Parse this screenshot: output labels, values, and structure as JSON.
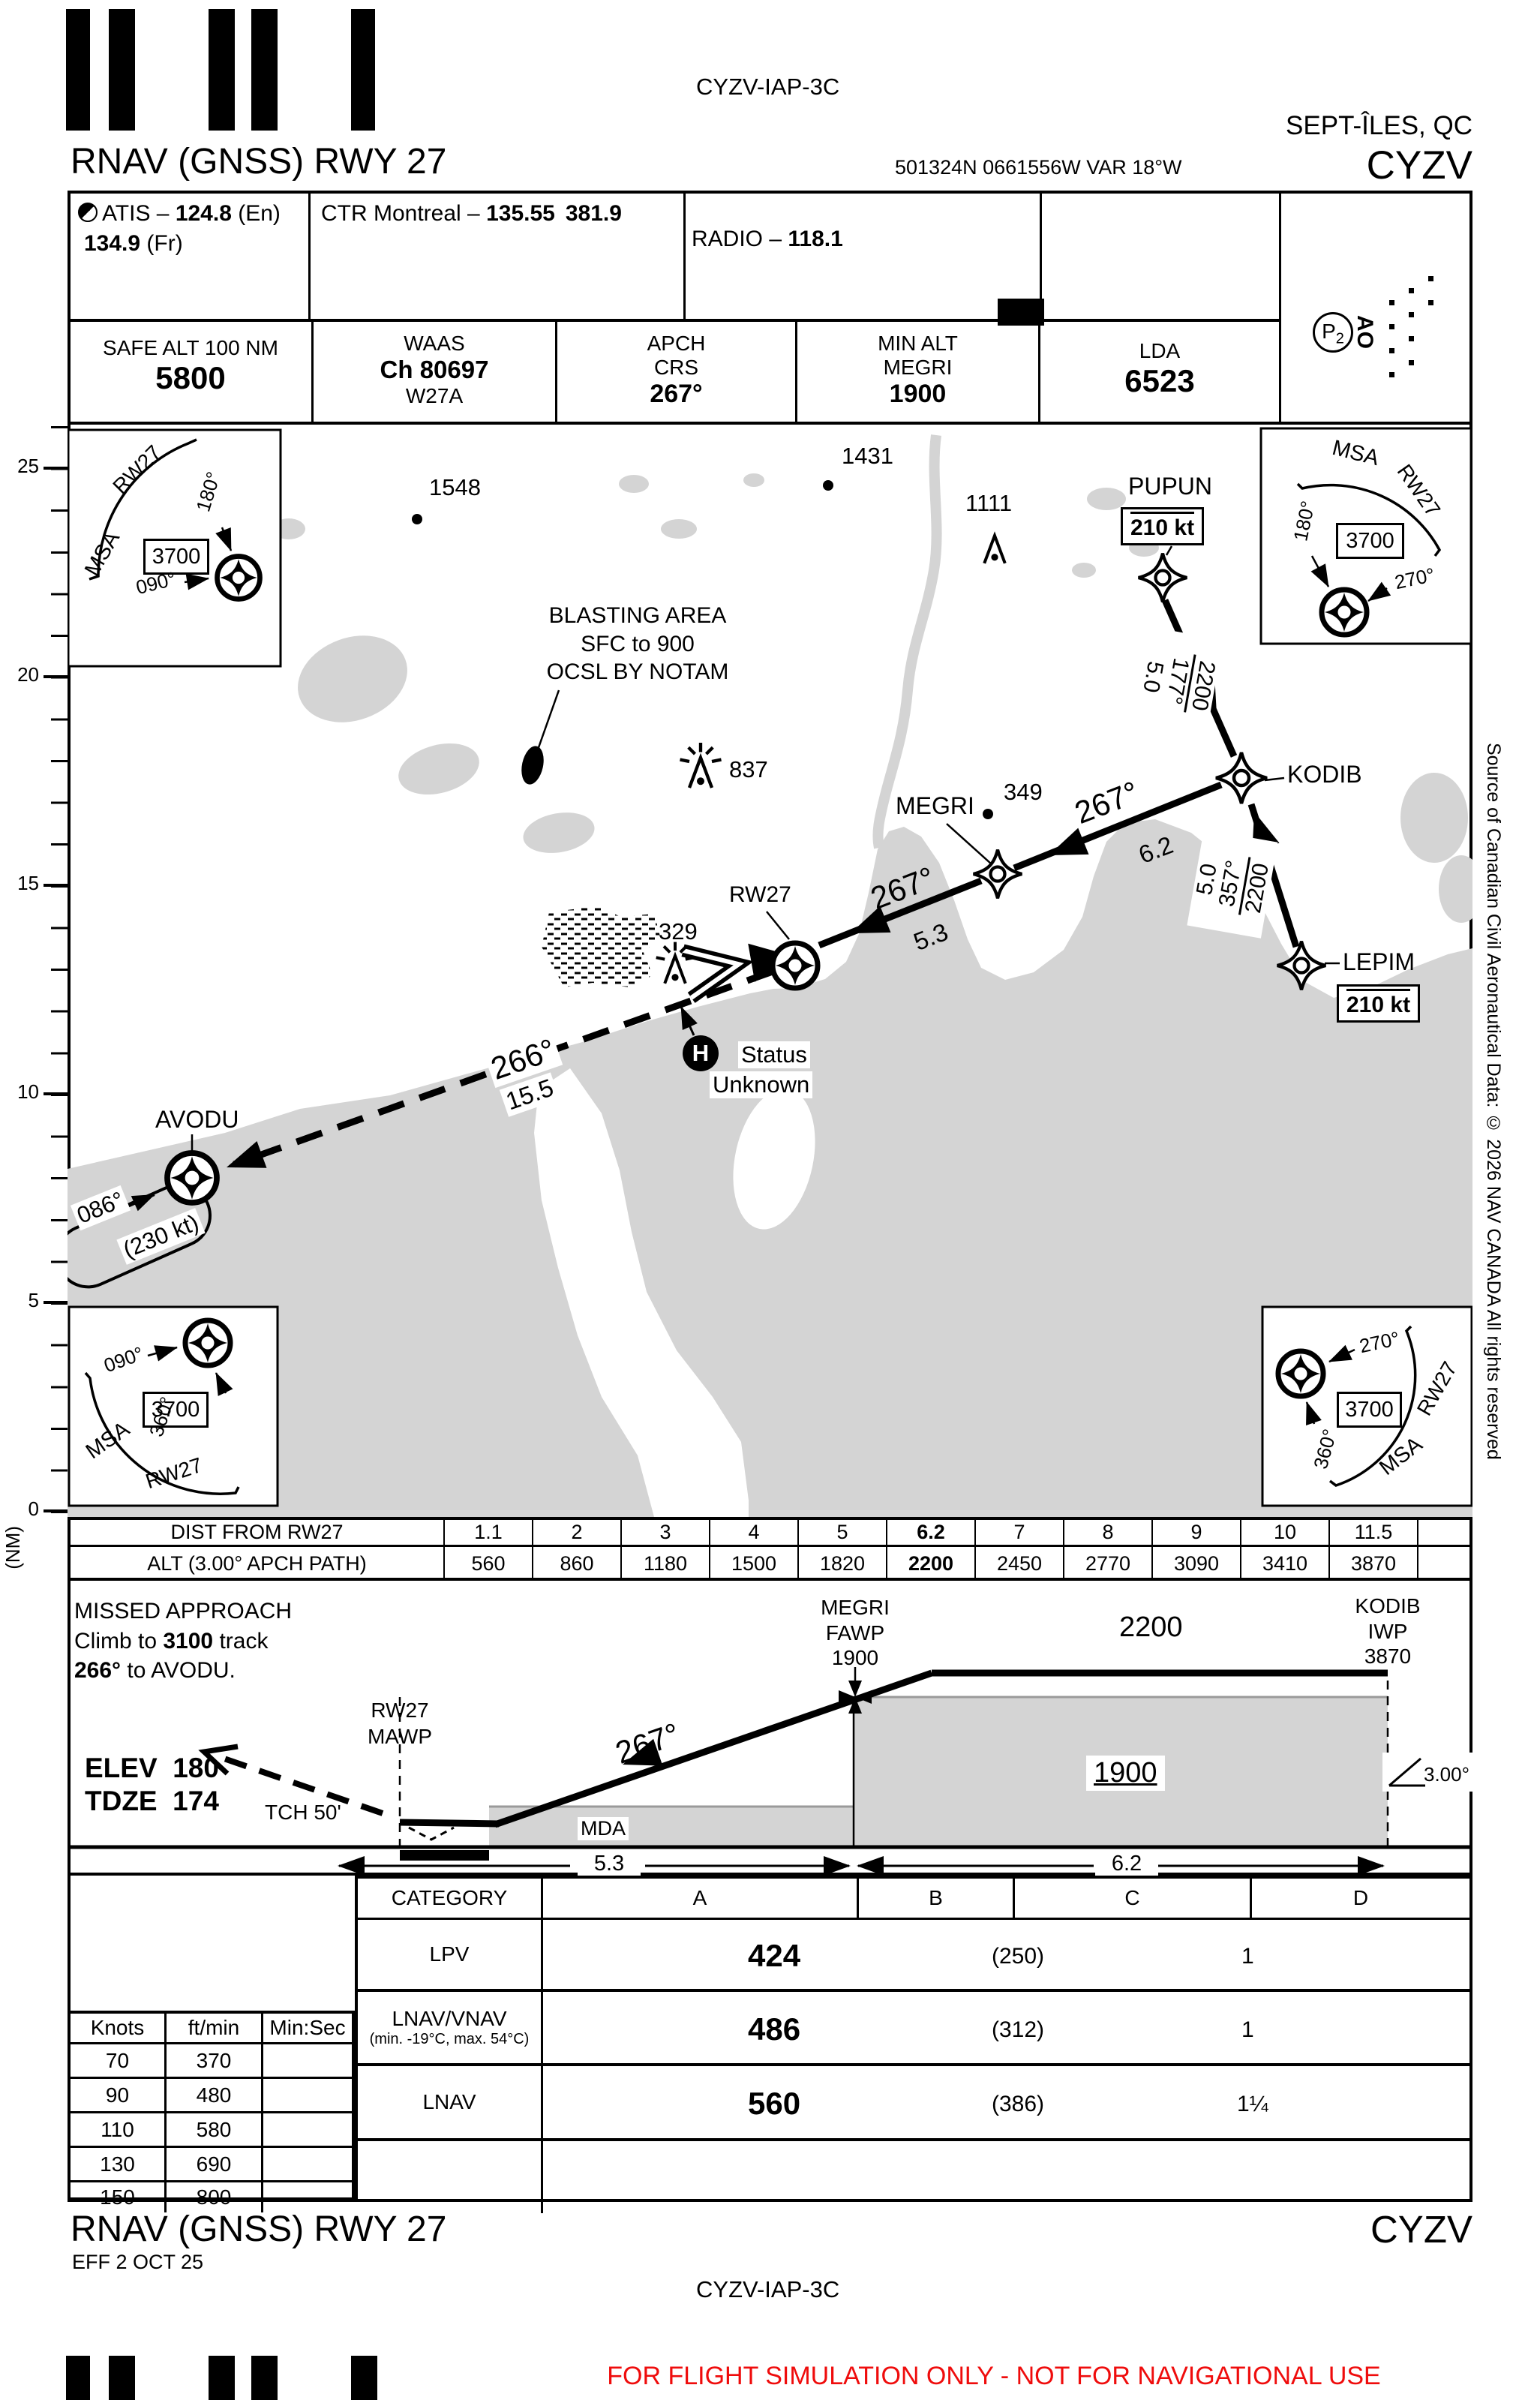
{
  "colors": {
    "terrain_gray": "#d4d4d4",
    "warning_red": "#ef0c0c"
  },
  "meta": {
    "iap_code_top": "CYZV-IAP-3C",
    "city": "SEPT-ÎLES, QC",
    "icao": "CYZV",
    "title": "RNAV (GNSS) RWY 27",
    "coords": "501324N  0661556W  VAR 18°W",
    "footer_title": "RNAV (GNSS) RWY 27",
    "footer_icao": "CYZV",
    "eff": "EFF 2 OCT 25",
    "iap_code_bottom": "CYZV-IAP-3C",
    "sim_warning": "FOR FLIGHT SIMULATION ONLY - NOT FOR NAVIGATIONAL USE",
    "source_note": "Source of Canadian Civil Aeronautical Data: © 2026 NAV CANADA All rights reserved"
  },
  "comm": {
    "atis_pre": "ATIS – ",
    "atis_freq": "124.8",
    "atis_en": " (En)",
    "atis_fr_freq": "134.9",
    "atis_fr": " (Fr)",
    "ctr_pre": "CTR Montreal – ",
    "ctr_vhf": "135.55",
    "ctr_uhf": "381.9",
    "radio_pre": "RADIO – ",
    "radio_freq": "118.1",
    "mf": "MF"
  },
  "databoxes": {
    "safe_alt_label": "SAFE ALT 100 NM",
    "safe_alt": "5800",
    "waas_label": "WAAS",
    "waas_ch": "Ch 80697",
    "waas_id": "W27A",
    "apch1": "APCH",
    "apch2": "CRS",
    "apch_crs": "267°",
    "minalt1": "MIN ALT",
    "minalt2": "MEGRI",
    "min_alt": "1900",
    "lda_label": "LDA",
    "lda": "6523",
    "p2": "P",
    "p2sub": "2",
    "ao": "AO"
  },
  "msa": {
    "msa": "MSA",
    "rwy": "RW27",
    "alt": "3700",
    "b090": "090°",
    "b180": "180°",
    "b270": "270°",
    "b360": "360°"
  },
  "scale": {
    "n25": "25",
    "n20": "20",
    "n15": "15",
    "n10": "10",
    "n5": "5",
    "n0": "0",
    "unit": "(NM)"
  },
  "map": {
    "fix_pupun": "PUPUN",
    "fix_kodib": "KODIB",
    "fix_megri": "MEGRI",
    "fix_lepim": "LEPIM",
    "fix_avodu": "AVODU",
    "fix_rw27": "RW27",
    "spd_pupun": "210 kt",
    "spd_lepim": "210 kt",
    "spd_hold": "(230 kt)",
    "hold_inbound": "086°",
    "leg1_alt": "2200",
    "leg1_crs": "177°",
    "leg1_dist": "5.0",
    "leg2_alt": "2200",
    "leg2_crs": "357°",
    "leg2_dist": "5.0",
    "leg3_crs": "267°",
    "leg3_dist": "6.2",
    "leg4_crs": "267°",
    "leg4_dist": "5.3",
    "missed_crs": "266°",
    "missed_dist": "15.5",
    "elev_1548": "1548",
    "elev_1431": "1431",
    "elev_1111": "1111",
    "elev_837": "837",
    "elev_349": "349",
    "elev_329": "329",
    "blasting1": "BLASTING AREA",
    "blasting2": "SFC to 900",
    "blasting3": "OCSL BY NOTAM",
    "heli": "H",
    "heli_status1": "Status",
    "heli_status2": "Unknown"
  },
  "dist_table": {
    "dist_label": "DIST FROM RW27",
    "alt_label": "ALT (3.00° APCH PATH)",
    "dist": [
      "1.1",
      "2",
      "3",
      "4",
      "5",
      "6.2",
      "7",
      "8",
      "9",
      "10",
      "11.5"
    ],
    "alt": [
      "560",
      "860",
      "1180",
      "1500",
      "1820",
      "2200",
      "2450",
      "2770",
      "3090",
      "3410",
      "3870"
    ]
  },
  "profile": {
    "missed1": "MISSED APPROACH",
    "missed2a": "Climb to ",
    "missed2b": "3100",
    "missed2c": " track",
    "missed3a": "266°",
    "missed3b": " to AVODU.",
    "elev_label": "ELEV",
    "elev": "180",
    "tdze_label": "TDZE",
    "tdze": "174",
    "tch": "TCH 50'",
    "mawp1": "RW27",
    "mawp2": "MAWP",
    "fawp1": "MEGRI",
    "fawp2": "FAWP",
    "fawp_alt": "1900",
    "seg_alt": "2200",
    "iwp1": "KODIB",
    "iwp2": "IWP",
    "iwp_alt": "3870",
    "mda_box": "1900",
    "mda": "MDA",
    "angle": "3.00°",
    "crs": "267°",
    "d1": "5.3",
    "d2": "6.2"
  },
  "minima": {
    "h_cat": "CATEGORY",
    "h_a": "A",
    "h_b": "B",
    "h_c": "C",
    "h_d": "D",
    "rows": [
      {
        "label": "LPV",
        "note": "",
        "da": "424",
        "hat": "(250)",
        "vis": "1"
      },
      {
        "label": "LNAV/VNAV",
        "note": "(min. -19°C, max. 54°C)",
        "da": "486",
        "hat": "(312)",
        "vis": "1"
      },
      {
        "label": "LNAV",
        "note": "",
        "da": "560",
        "hat": "(386)",
        "vis": "1¼"
      }
    ]
  },
  "speed_table": {
    "h1": "Knots",
    "h2": "ft/min",
    "h3": "Min:Sec",
    "rows": [
      [
        "70",
        "370"
      ],
      [
        "90",
        "480"
      ],
      [
        "110",
        "580"
      ],
      [
        "130",
        "690"
      ],
      [
        "150",
        "800"
      ]
    ]
  }
}
